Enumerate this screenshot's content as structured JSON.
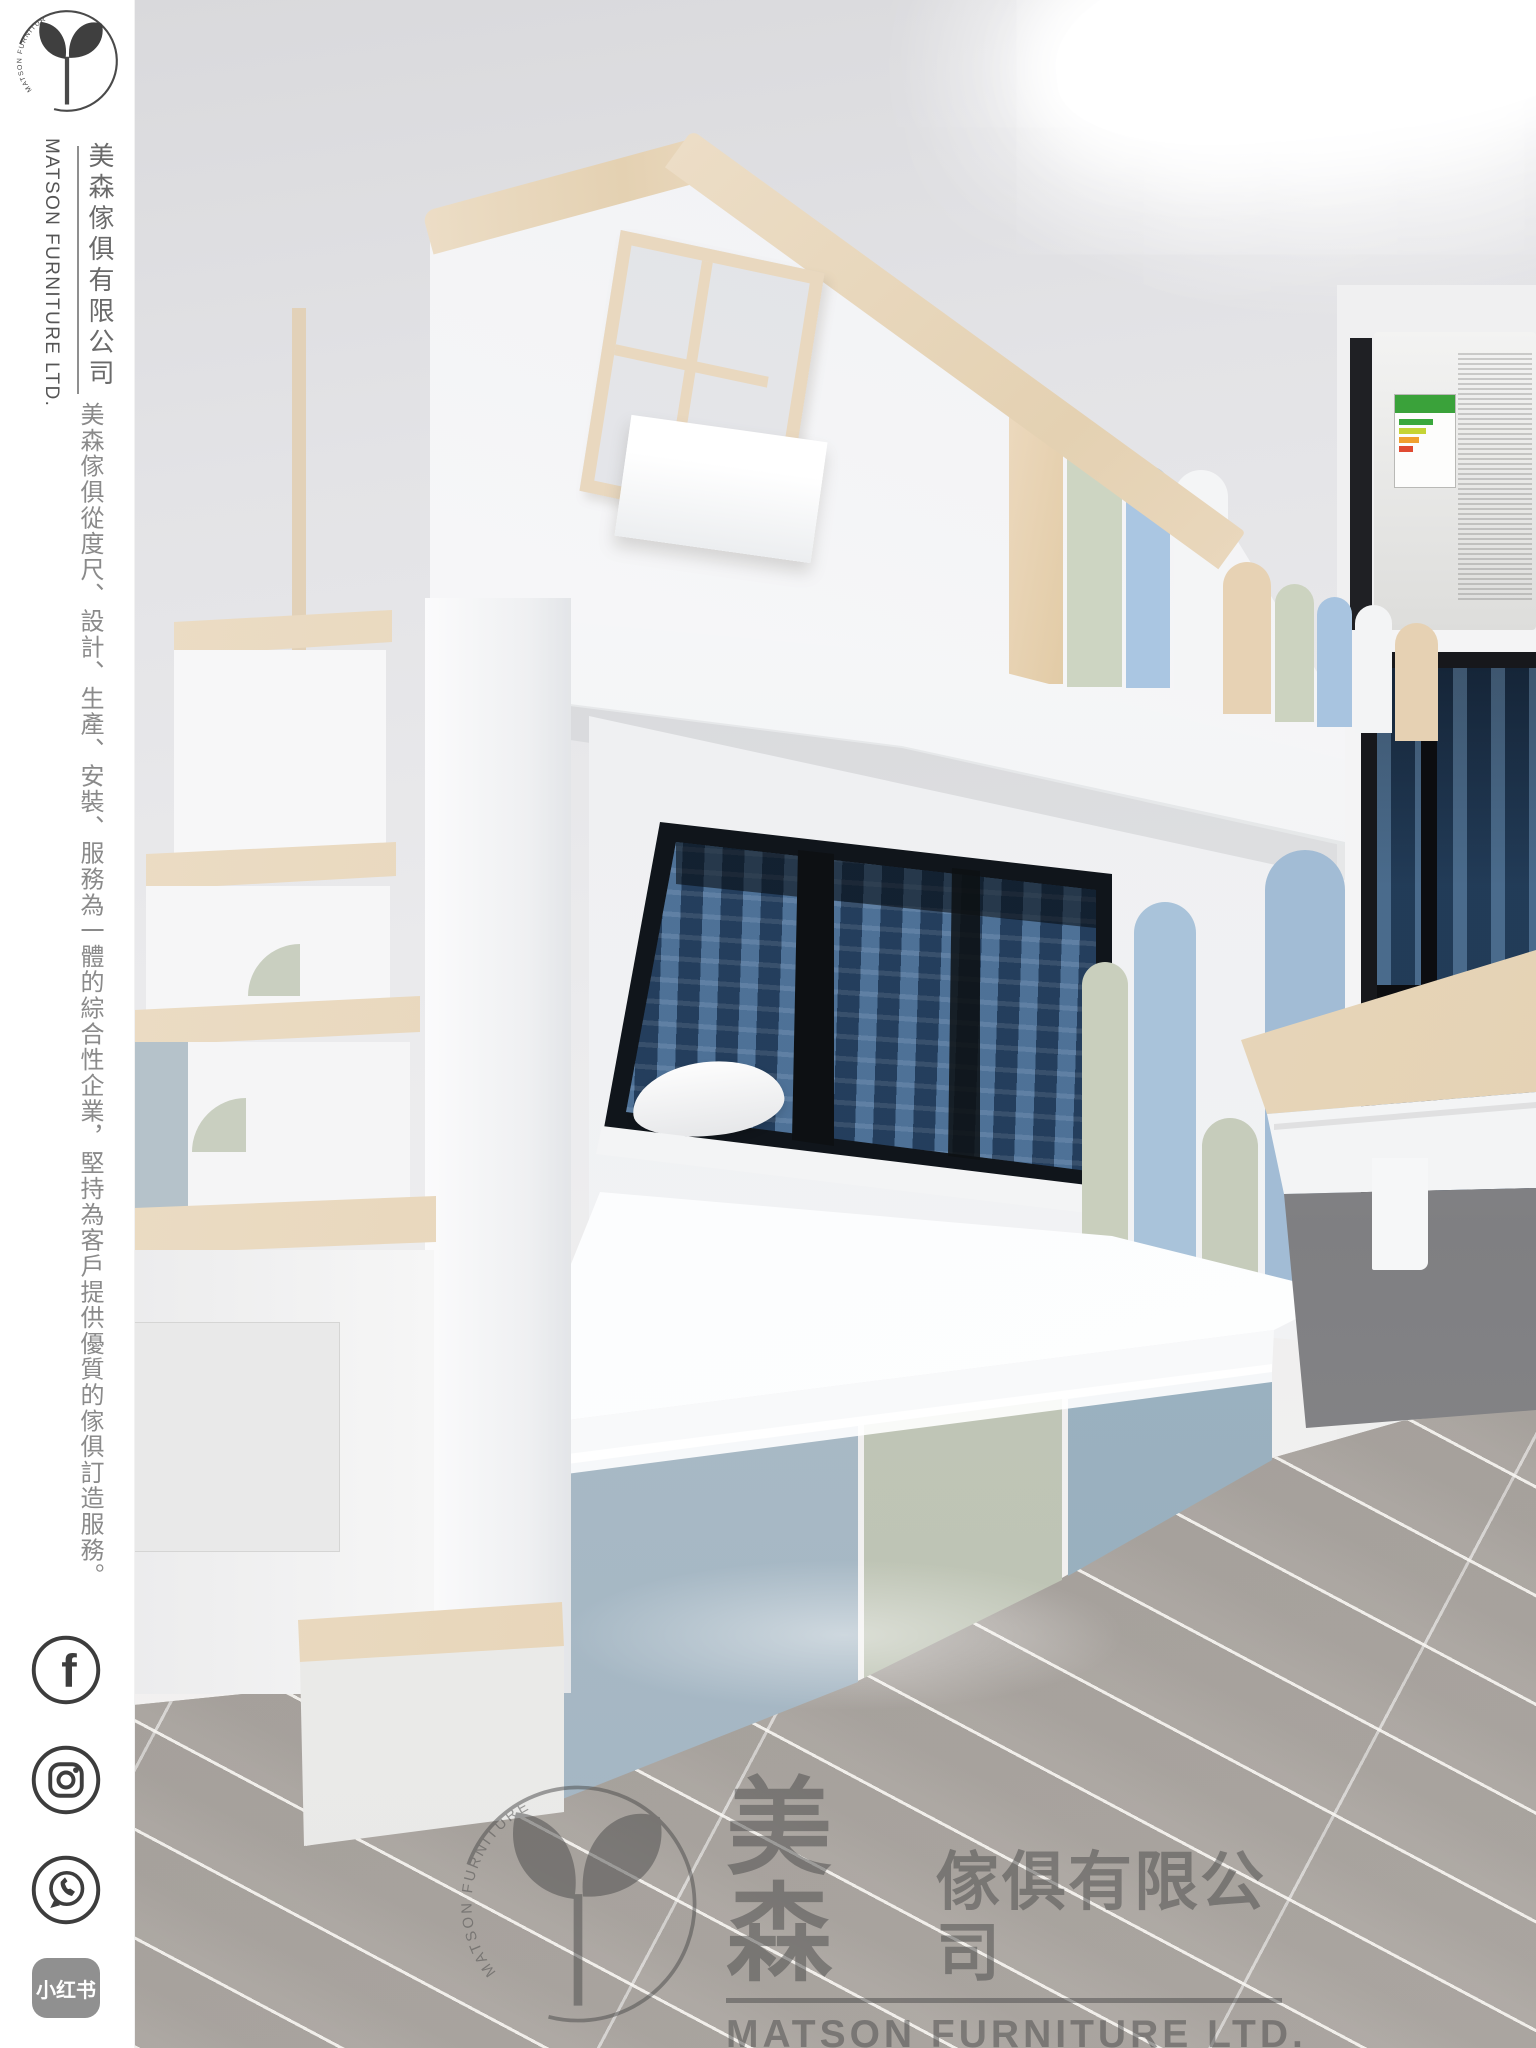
{
  "brand": {
    "logo_ring_text": "MATSON FURNITURE",
    "name_en": "MATSON FURNITURE LTD.",
    "name_zh": "美森傢俱有限公司"
  },
  "sidebar": {
    "tagline_zh": "美森傢俱從度尺、設計、生產、安裝、服務為一體的綜合性企業，堅持為客戶提供優質的傢俱訂造服務。",
    "social": {
      "facebook": "facebook",
      "instagram": "instagram",
      "whatsapp": "whatsapp",
      "xiaohongshu_label": "小红书"
    }
  },
  "watermark": {
    "ring_text": "MATSON FURNITURE",
    "zh_large": "美森",
    "zh_rest": "傢俱有限公司",
    "en": "MATSON FURNITURE LTD."
  },
  "palette": {
    "wood": "#e9d8bf",
    "sage_green": "#ccd4c1",
    "sky_blue": "#a9c4e0",
    "blue_gray_drawer": "#9eb5c3",
    "wall_gray": "#e9e9eb",
    "floor_gray": "#b3aea8",
    "night_window_blue": "#2a4662",
    "white_furniture": "#f7f8f9"
  }
}
